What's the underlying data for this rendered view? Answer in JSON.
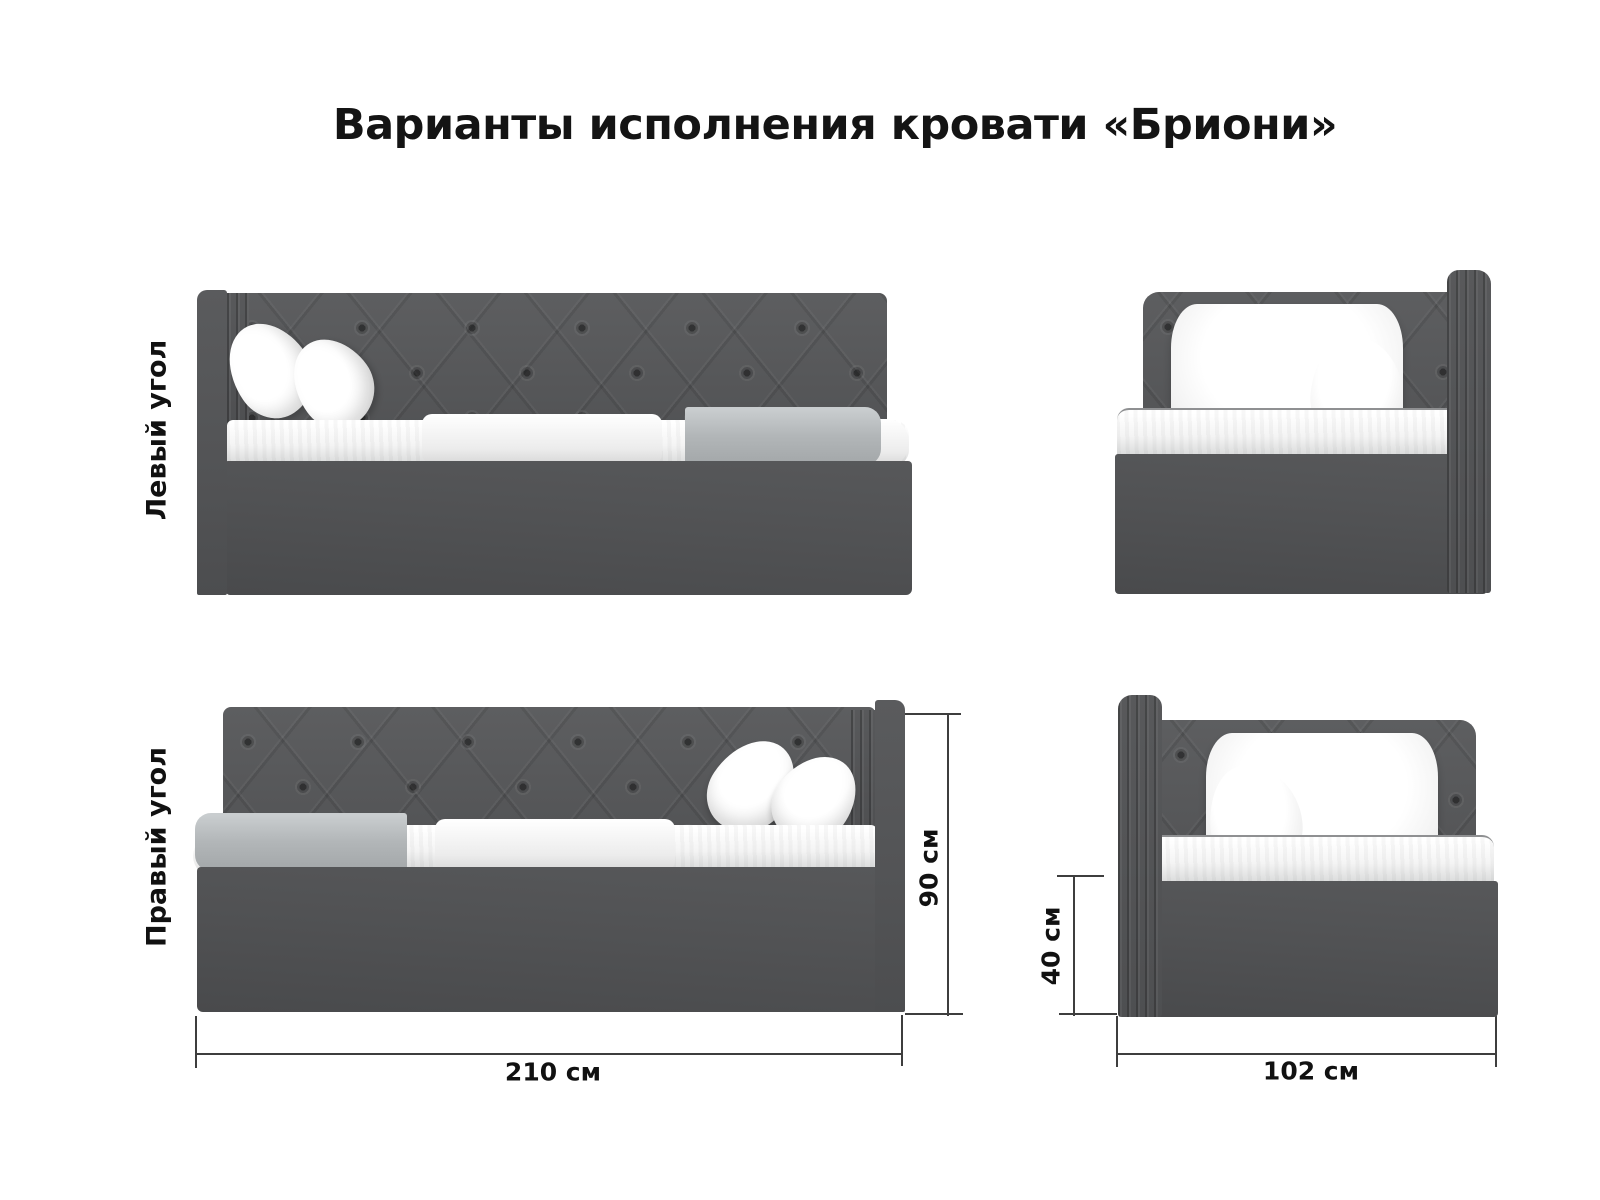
{
  "title": "Варианты исполнения кровати «Бриони»",
  "rows": [
    {
      "label": "Левый угол"
    },
    {
      "label": "Правый угол"
    }
  ],
  "dimensions": {
    "length": "210 см",
    "height": "90 см",
    "base_height": "40 см",
    "width": "102 см"
  },
  "colors": {
    "bed_fabric": "#57585a",
    "bed_base": "#505153",
    "blanket": "#b4b8ba",
    "bedding": "#f5f5f5",
    "text": "#121212",
    "dimension_line": "#3e3e3e",
    "background": "#ffffff"
  }
}
